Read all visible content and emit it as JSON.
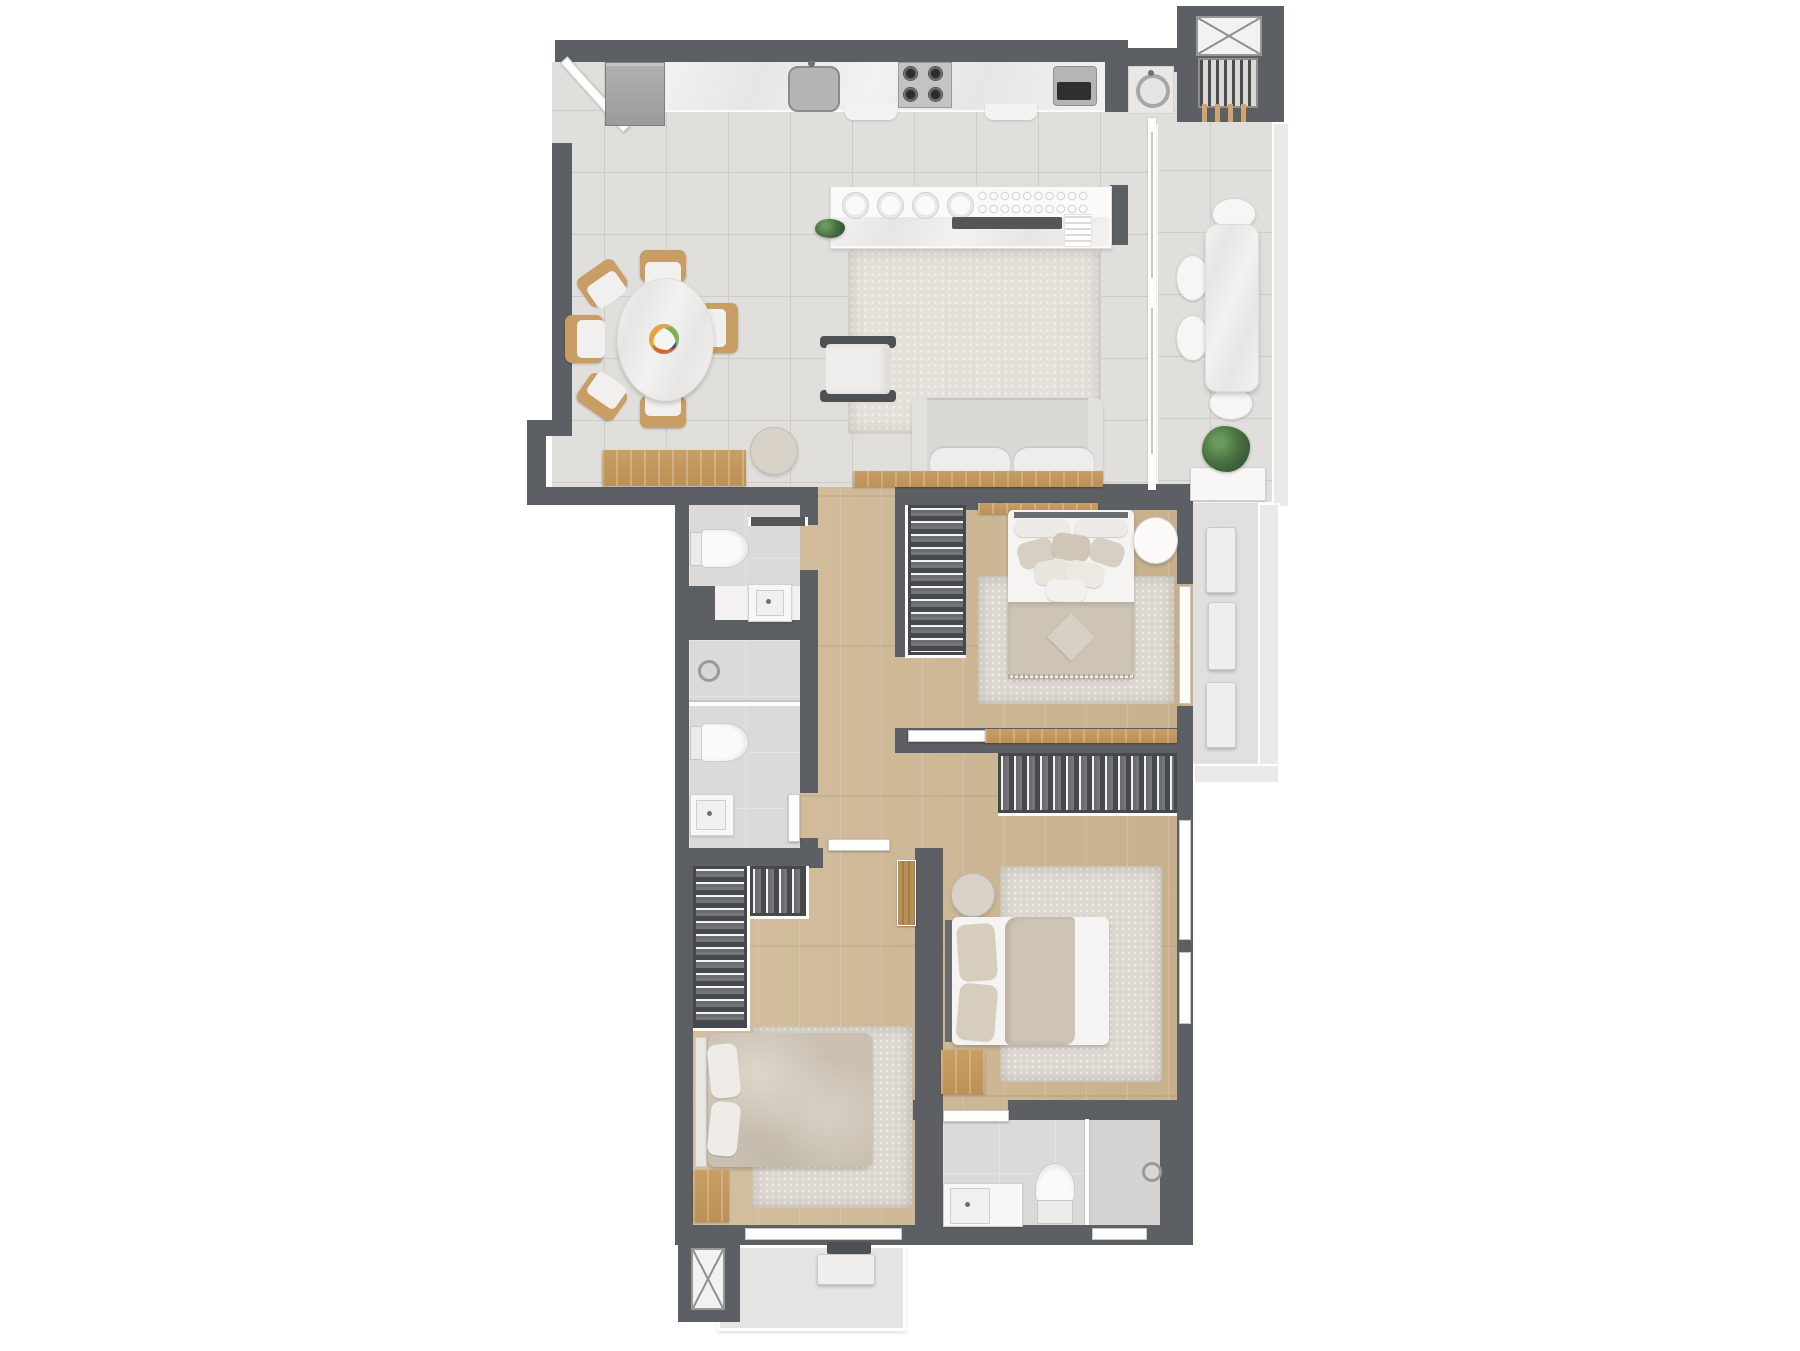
{
  "document": {
    "kind": "apartment-floor-plan-render",
    "style": "top-down 3D render, no text labels"
  },
  "palette": {
    "background": "#ffffff",
    "wall": "#5c5f63",
    "tile_floor": "#e0dfdc",
    "grout": "#cdccc9",
    "wood_floor": "#d4bf9f",
    "wood_floor_dark": "#c7b08c",
    "bath_floor": "#dbdad8",
    "marble_light": "#f3f2f0",
    "marble_shadow": "#e7e6e4",
    "fixture_white": "#f8f7f5",
    "fixture_border": "#d2d1cf",
    "rug_living": "#e3e0da",
    "rug_bedroom": "#dcd7cf",
    "sofa": "#d9d8d5",
    "cushion": "#eeedeb",
    "dark_frame": "#4e5154",
    "blanket_beige": "#cdc4b5",
    "duvet_beige": "#c9c0b2",
    "wood_accent": "#c89e64",
    "wood_door": "#b98f58",
    "closet_interior": "#45484c",
    "plant_green": "#4a7242",
    "steel": "#b6b7b5",
    "appliance_dark": "#2d2f31",
    "ac_white": "#f0efed",
    "ledge_floor": "#e6e5e3",
    "tech_floor": "#e1e0de",
    "parapet": "#ebeae8"
  },
  "rooms": [
    {
      "name": "kitchen-living-dining",
      "floor": "ceramic-tile",
      "items": [
        "entry-door",
        "refrigerator",
        "marble-counter",
        "kitchen-sink",
        "gas-cooktop-4-burners",
        "built-in-appliance",
        "round-dining-table",
        "fruit-bowl",
        "dining-chairs x6",
        "buffet-island",
        "plates x4",
        "glass-rack",
        "media-tray",
        "small-plant",
        "napkin-stack",
        "area-rug",
        "armchair",
        "two-seat-sofa",
        "wood-console",
        "wood-bench",
        "round-side-table"
      ]
    },
    {
      "name": "balcony",
      "floor": "ceramic-tile",
      "items": [
        "sliding-glass-door",
        "long-marble-table",
        "round-chairs x4",
        "planter",
        "potted-plant",
        "parapet"
      ]
    },
    {
      "name": "laundry-nook",
      "items": [
        "round-wash-basin",
        "drying-rack",
        "clothespins"
      ]
    },
    {
      "name": "shaft-top",
      "items": [
        "x-cross-symbol"
      ]
    },
    {
      "name": "powder-room",
      "items": [
        "toilet",
        "washbasin",
        "wall-shelf"
      ]
    },
    {
      "name": "bathroom-middle",
      "items": [
        "shower-head",
        "glass-partition",
        "toilet",
        "vanity-washbasin",
        "door"
      ]
    },
    {
      "name": "hallway",
      "floor": "wood",
      "items": [
        "doors x3"
      ]
    },
    {
      "name": "bedroom-1",
      "floor": "wood",
      "items": [
        "double-bed",
        "pillows x8",
        "beige-blanket-with-diamond-cushion",
        "open-closet-with-clothes",
        "round-side-table",
        "area-rug",
        "wood-headboard-shelf",
        "wood-desk-shelf",
        "window"
      ]
    },
    {
      "name": "bedroom-2",
      "floor": "wood",
      "items": [
        "double-bed",
        "pillows x2",
        "beige-throw",
        "wardrobe-with-clothes",
        "round-side-table",
        "wood-nightstand",
        "area-rug",
        "windows x2",
        "wood-door"
      ]
    },
    {
      "name": "bedroom-3",
      "floor": "wood",
      "items": [
        "double-bed-rumpled-duvet",
        "pillows x2",
        "l-shaped-closet-with-clothes",
        "wood-nightstand",
        "area-rug",
        "window"
      ]
    },
    {
      "name": "ensuite-bathroom",
      "items": [
        "vanity-washbasin",
        "toilet",
        "shower",
        "glass-partition",
        "window",
        "door"
      ]
    },
    {
      "name": "technical-balcony",
      "items": [
        "ac-condenser x3",
        "parapet"
      ]
    },
    {
      "name": "service-ledge-bottom",
      "items": [
        "ac-condenser",
        "vent"
      ]
    },
    {
      "name": "shaft-bottom",
      "items": [
        "x-cross-symbol"
      ]
    }
  ],
  "counts": {
    "bedrooms": 3,
    "bathrooms": 3,
    "dining_chairs": 6,
    "balcony_chairs": 4,
    "ac_condensers": 4,
    "shafts": 2
  }
}
